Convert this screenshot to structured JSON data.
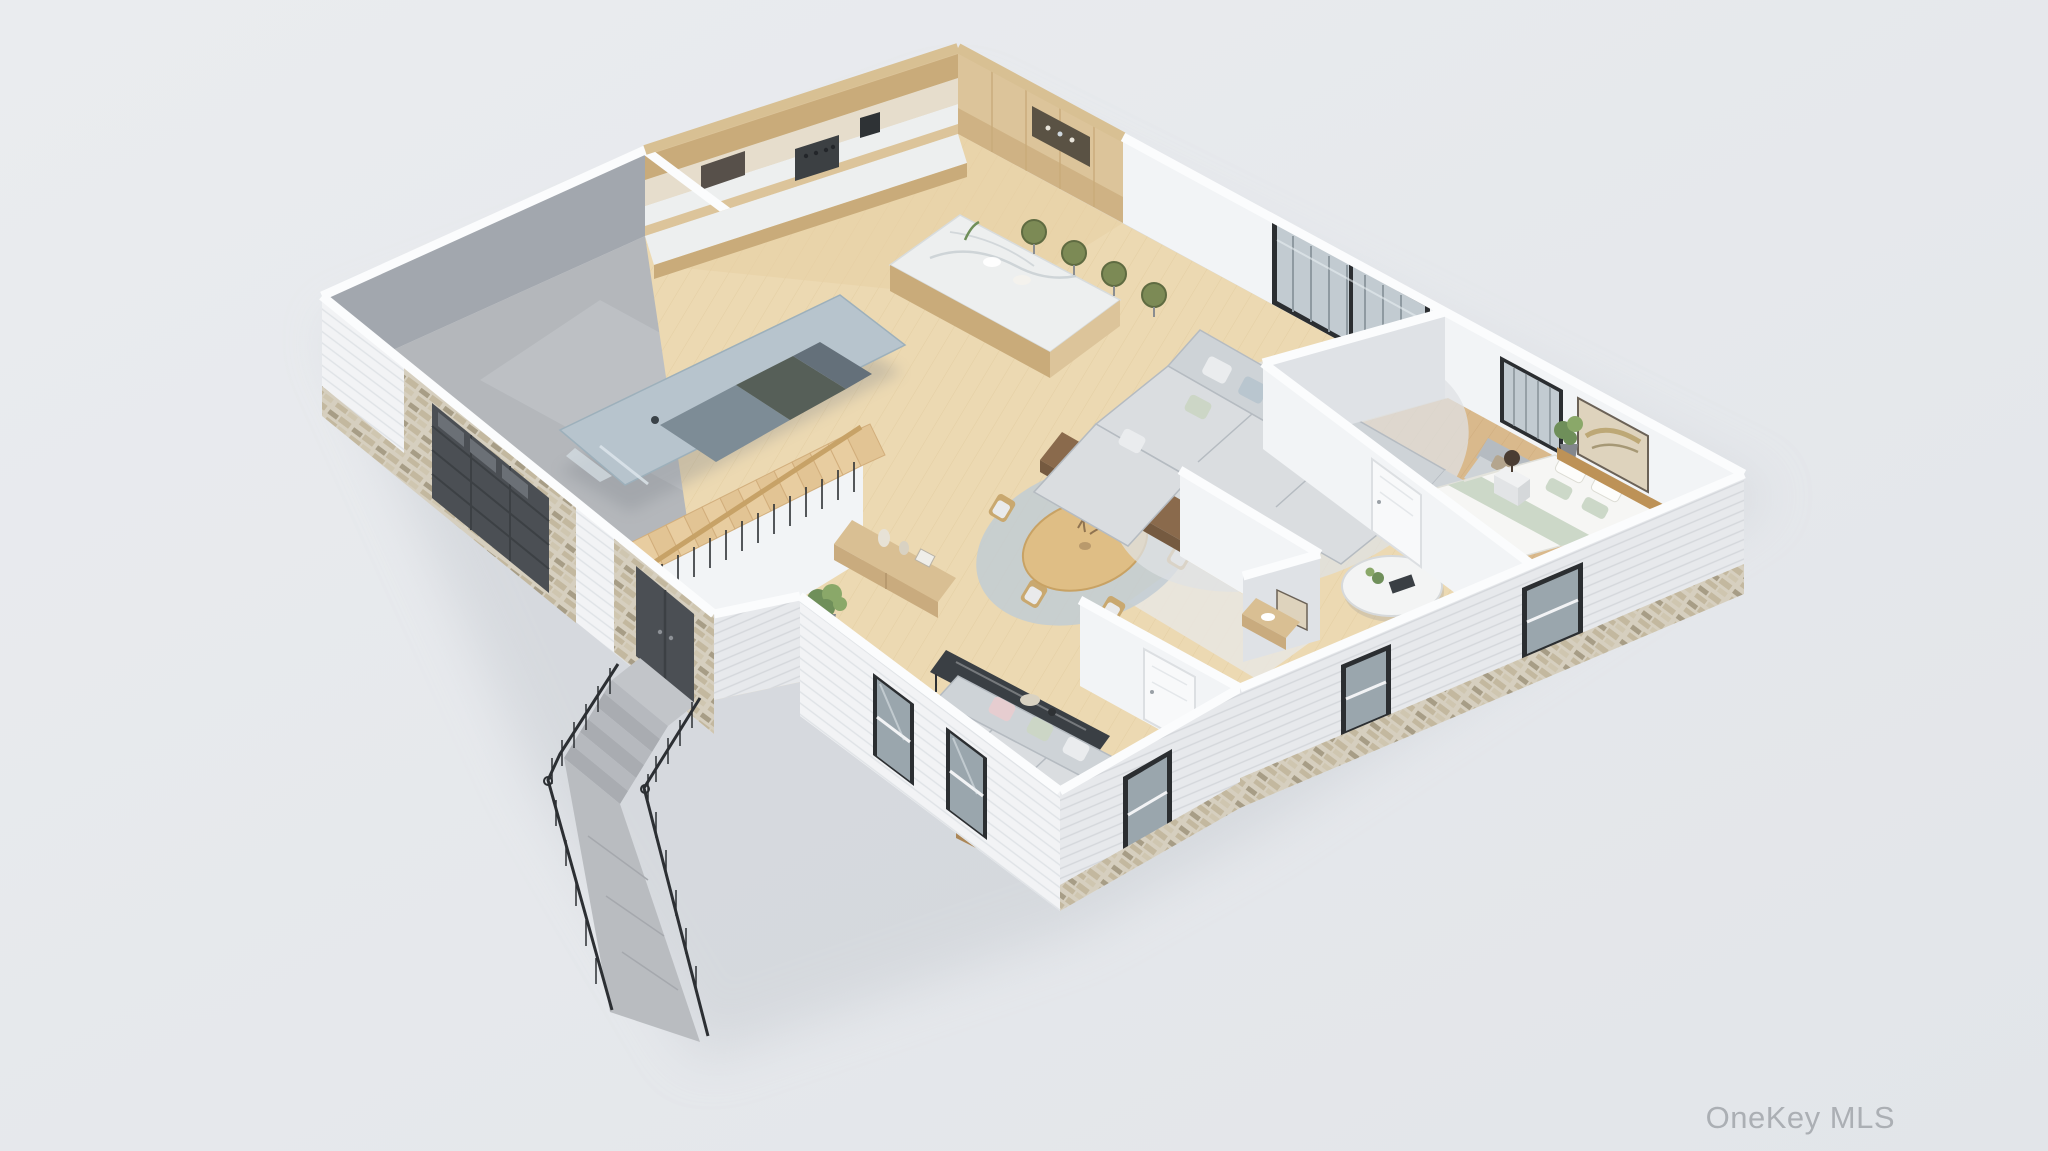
{
  "watermark": {
    "text": "OneKey MLS"
  },
  "scene": {
    "description": "3D isometric dollhouse rendering of a single-story home floor plan",
    "rooms": [
      {
        "name": "garage",
        "contents": [
          "car",
          "garage-door"
        ]
      },
      {
        "name": "kitchen",
        "contents": [
          "wood-cabinets",
          "range",
          "marble-island",
          "green-bar-stools"
        ]
      },
      {
        "name": "living-room",
        "contents": [
          "sectional-sofa",
          "round-coffee-table",
          "armchair",
          "walnut-console",
          "sliding-glass-door",
          "rug"
        ]
      },
      {
        "name": "dining-area",
        "contents": [
          "round-table",
          "six-chairs",
          "round-rug",
          "oak-sideboard",
          "potted-plant"
        ]
      },
      {
        "name": "bedroom",
        "contents": [
          "bed",
          "headboard",
          "nightstand",
          "lamp",
          "window",
          "artwork"
        ]
      },
      {
        "name": "hall-bath",
        "contents": [
          "vanity",
          "interior-doors",
          "artwork"
        ]
      },
      {
        "name": "family-room",
        "contents": [
          "sofa",
          "glass-console",
          "wood-coffee-table",
          "gold-lantern",
          "windows",
          "rug"
        ]
      },
      {
        "name": "entry",
        "contents": [
          "front-door",
          "staircase",
          "black-balusters"
        ]
      },
      {
        "name": "exterior",
        "contents": [
          "porch-steps",
          "walkway",
          "black-railings",
          "stone-veneer",
          "white-siding"
        ]
      }
    ]
  },
  "palette": {
    "bg": "#eaecef",
    "bgDeep": "#e2e5e9",
    "shadow": "#c9cdd3",
    "capWhite": "#fbfcfd",
    "woodWallCap": "#d8c093",
    "wallLight": "#f2f4f6",
    "wallShade": "#dfe2e6",
    "wallMid": "#c6cad0",
    "wallDark": "#a2a7ae",
    "siding": "#f2f3f5",
    "sidingLine": "#dfe2e6",
    "sidingShade": "#e7e9ec",
    "sidingShadeLine": "#d4d7db",
    "stone": "#d6cfbf",
    "stone2": "#c3b89f",
    "stone3": "#a79d86",
    "stone4": "#cfc6b0",
    "frame": "#2b2e31",
    "glass": "#c2cbd1",
    "glassDark": "#9aa6ad",
    "glassSheen": "#e8eef2",
    "doorDark": "#4b4f54",
    "doorLine": "#3c4044",
    "woodCab": "#dcc49a",
    "woodCabDark": "#c9ab7a",
    "marble": "#edefef",
    "marbleVein": "#c6cdd1",
    "stoolGreen": "#7c8a55",
    "stoolGreenDark": "#5f6b41",
    "floorMain": "#ecd9b2",
    "floorPlank": "#dcc697",
    "floorKitchenTint": "#e7d0a4",
    "floorBed": "#d9b98c",
    "floorBedPlank": "#c8a272",
    "concrete": "#b4b7bb",
    "concreteLight": "#c6c9cd",
    "carBody": "#b7c4cd",
    "carGlass": "#64707a",
    "carRoof": "#565f58",
    "carShadow": "#7e838a",
    "tread": "#e8cda0",
    "riser": "#d2ae7c",
    "stairRail": "#c7a267",
    "railBlack": "#2c2f33",
    "oakFurn": "#d9bf93",
    "oakFurnDark": "#c9ab7e",
    "walnut": "#8a6a4c",
    "walnutDark": "#755a40",
    "tableWood": "#dfbe85",
    "chairWood": "#c9a86f",
    "chairSeat": "#e9eaeb",
    "rugBlue": "#c2ccd3",
    "rugLight": "#dfe2e4",
    "rugFamily": "#e3e6e8",
    "sofaGray": "#ced3d7",
    "sofaGraySeat": "#dadde0",
    "sofaGrayDark": "#b5bbc1",
    "pillowLight": "#eaecee",
    "pillowBlue": "#b9c6cf",
    "pillowSage": "#ccd6c6",
    "pillowBlush": "#e6cdd0",
    "bedWhite": "#f6f6f4",
    "bedSage": "#ccd8c8",
    "headboard": "#bd9257",
    "lampDark": "#4a3d33",
    "nightstand": "#f0f1f2",
    "plant": "#6f8f5a",
    "plantLight": "#8aa869",
    "pot": "#83878c",
    "stepGray": "#b6b9be",
    "stepGrayDark": "#a9acb1",
    "stoop": "#c2c5c9",
    "walkway": "#b9bcc0",
    "gold": "#c8a04e",
    "glassTable": "#3a3f44",
    "tile": "#e9e6df",
    "artBeige": "#ded3bd",
    "artFrame": "#6b6257",
    "artSwash": "#b7a06a",
    "watermark": "#a9adb2"
  }
}
